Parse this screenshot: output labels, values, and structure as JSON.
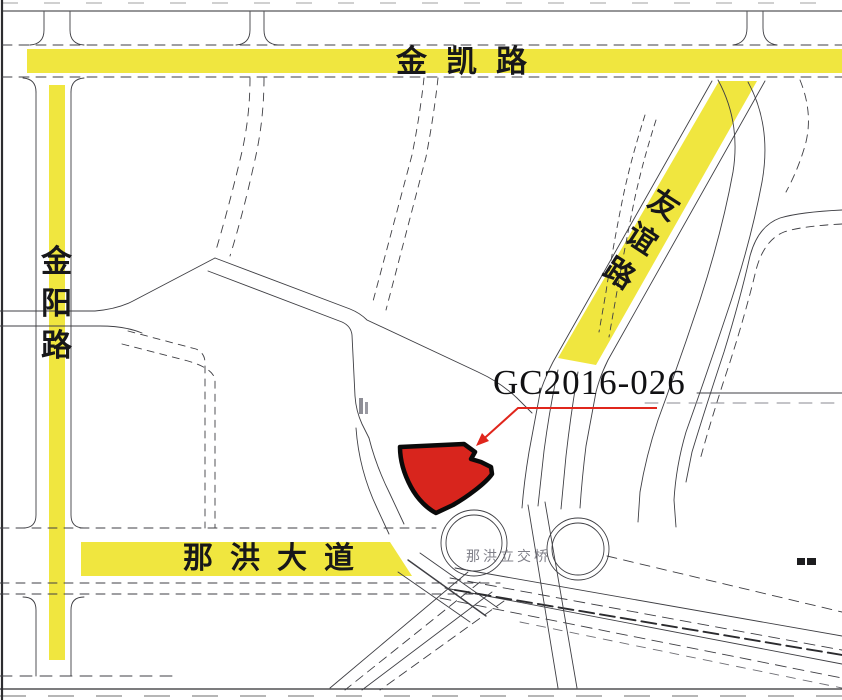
{
  "map": {
    "type": "parcel-location-map",
    "parcel_label": "GC2016-026",
    "roads": {
      "top": {
        "name": "金凯路"
      },
      "left": {
        "name": "金阳路",
        "chars": [
          "金",
          "阳",
          "路"
        ]
      },
      "diagonal": {
        "name": "友谊路",
        "chars": [
          "友",
          "谊",
          "路"
        ]
      },
      "bottom": {
        "name": "那洪大道"
      }
    },
    "interchange_label": "那洪立交桥",
    "colors": {
      "road_highlight_yellow": "#f0e63f",
      "parcel_fill_red": "#d8251d",
      "parcel_outline": "#0a0a0a",
      "leader_red": "#e0261c",
      "road_line": "#3f3f44",
      "faint_text": "#6a6a74",
      "background": "#ffffff"
    }
  }
}
